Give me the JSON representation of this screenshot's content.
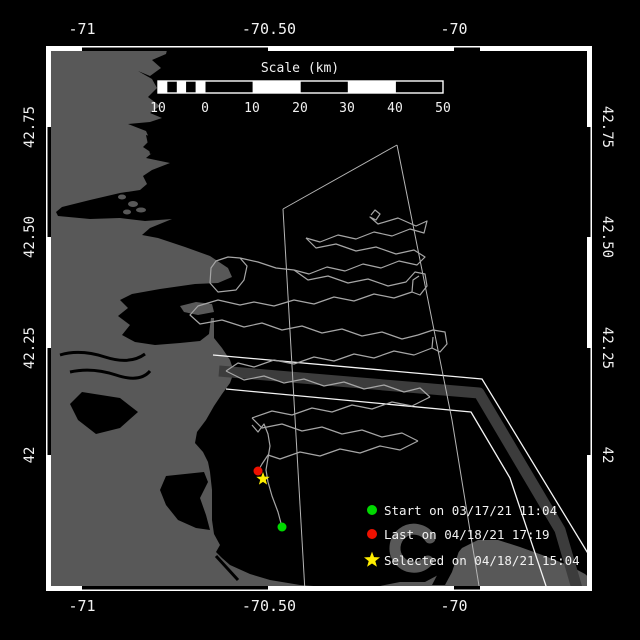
{
  "colors": {
    "background": "#000000",
    "land": "#585858",
    "water": "#000000",
    "frame": "#ffffff",
    "track": "#a6a6a6",
    "survey_line": "#b5b5b5",
    "lane_line": "#f4f4f4",
    "separation_zone": "#3c3c3c",
    "text": "#f2f2f2",
    "start_marker": "#00d800",
    "last_marker": "#ee1100",
    "selected_marker": "#ffee00"
  },
  "top_axis": {
    "ticks": [
      {
        "label": "-71"
      },
      {
        "label": "-70.50"
      },
      {
        "label": "-70"
      }
    ]
  },
  "bottom_axis": {
    "ticks": [
      {
        "label": "-71"
      },
      {
        "label": "-70.50"
      },
      {
        "label": "-70"
      }
    ]
  },
  "left_axis": {
    "ticks": [
      {
        "label": "42.75"
      },
      {
        "label": "42.50"
      },
      {
        "label": "42.25"
      },
      {
        "label": "42"
      }
    ]
  },
  "right_axis": {
    "ticks": [
      {
        "label": "42.75"
      },
      {
        "label": "42.50"
      },
      {
        "label": "42.25"
      },
      {
        "label": "42"
      }
    ]
  },
  "scale_bar": {
    "title": "Scale (km)",
    "tick_labels": [
      "10",
      "0",
      "10",
      "20",
      "30",
      "40",
      "50"
    ]
  },
  "legend": {
    "items": [
      {
        "marker": "circle",
        "color": "#00d800",
        "label": "Start on 03/17/21 11:04"
      },
      {
        "marker": "circle",
        "color": "#ee1100",
        "label": "Last on 04/18/21 17:19"
      },
      {
        "marker": "star",
        "color": "#ffee00",
        "label": "Selected on 04/18/21 15:04"
      }
    ]
  },
  "map": {
    "markers": {
      "start": {
        "x": 282,
        "y": 527
      },
      "last": {
        "x": 258,
        "y": 471
      },
      "selected": {
        "x": 263,
        "y": 479
      }
    },
    "survey_lines": [
      [
        [
          283,
          209
        ],
        [
          397,
          145
        ]
      ],
      [
        [
          397,
          145
        ],
        [
          452,
          420
        ],
        [
          480,
          592
        ]
      ],
      [
        [
          283,
          209
        ],
        [
          305,
          592
        ]
      ]
    ],
    "lane": {
      "north": [
        [
          213,
          355
        ],
        [
          482,
          379
        ],
        [
          592,
          560
        ]
      ],
      "band": [
        [
          219,
          371
        ],
        [
          479,
          393
        ],
        [
          560,
          530
        ],
        [
          578,
          592
        ]
      ],
      "south": [
        [
          226,
          389
        ],
        [
          471,
          412
        ],
        [
          510,
          478
        ],
        [
          548,
          592
        ]
      ]
    },
    "tracks": [
      [
        [
          371,
          215
        ],
        [
          375,
          210
        ],
        [
          380,
          214
        ],
        [
          376,
          220
        ],
        [
          370,
          217
        ],
        [
          378,
          224
        ],
        [
          398,
          218
        ],
        [
          416,
          226
        ],
        [
          427,
          221
        ],
        [
          424,
          233
        ],
        [
          410,
          229
        ],
        [
          392,
          236
        ],
        [
          374,
          232
        ],
        [
          356,
          239
        ],
        [
          338,
          235
        ],
        [
          320,
          242
        ],
        [
          306,
          238
        ]
      ],
      [
        [
          306,
          238
        ],
        [
          316,
          248
        ],
        [
          336,
          244
        ],
        [
          356,
          251
        ],
        [
          376,
          247
        ],
        [
          396,
          254
        ],
        [
          414,
          250
        ],
        [
          425,
          257
        ],
        [
          417,
          265
        ],
        [
          399,
          261
        ],
        [
          381,
          268
        ],
        [
          363,
          264
        ],
        [
          345,
          271
        ],
        [
          327,
          267
        ],
        [
          309,
          274
        ],
        [
          294,
          270
        ]
      ],
      [
        [
          240,
          258
        ],
        [
          247,
          266
        ],
        [
          244,
          280
        ],
        [
          236,
          290
        ],
        [
          218,
          292
        ],
        [
          210,
          283
        ],
        [
          211,
          268
        ],
        [
          216,
          261
        ],
        [
          228,
          257
        ],
        [
          240,
          258
        ],
        [
          258,
          262
        ],
        [
          276,
          268
        ],
        [
          294,
          270
        ]
      ],
      [
        [
          294,
          270
        ],
        [
          308,
          280
        ],
        [
          328,
          276
        ],
        [
          348,
          283
        ],
        [
          368,
          279
        ],
        [
          388,
          286
        ],
        [
          406,
          282
        ],
        [
          415,
          272
        ],
        [
          425,
          274
        ],
        [
          427,
          286
        ],
        [
          420,
          295
        ],
        [
          412,
          292
        ],
        [
          413,
          280
        ],
        [
          419,
          276
        ]
      ],
      [
        [
          412,
          292
        ],
        [
          394,
          298
        ],
        [
          374,
          294
        ],
        [
          354,
          301
        ],
        [
          334,
          297
        ],
        [
          314,
          304
        ],
        [
          294,
          300
        ],
        [
          274,
          306
        ],
        [
          254,
          302
        ],
        [
          240,
          305
        ],
        [
          218,
          300
        ],
        [
          198,
          306
        ],
        [
          190,
          315
        ],
        [
          200,
          324
        ],
        [
          222,
          320
        ],
        [
          244,
          327
        ],
        [
          262,
          323
        ],
        [
          282,
          330
        ],
        [
          302,
          326
        ],
        [
          322,
          333
        ],
        [
          342,
          329
        ],
        [
          362,
          336
        ],
        [
          382,
          332
        ],
        [
          402,
          339
        ],
        [
          418,
          335
        ]
      ],
      [
        [
          418,
          335
        ],
        [
          433,
          330
        ],
        [
          445,
          332
        ],
        [
          447,
          344
        ],
        [
          440,
          352
        ],
        [
          432,
          348
        ],
        [
          433,
          337
        ]
      ],
      [
        [
          432,
          348
        ],
        [
          414,
          355
        ],
        [
          394,
          351
        ],
        [
          374,
          358
        ],
        [
          354,
          354
        ],
        [
          334,
          361
        ],
        [
          314,
          357
        ],
        [
          294,
          364
        ],
        [
          274,
          360
        ],
        [
          254,
          367
        ],
        [
          238,
          363
        ],
        [
          226,
          371
        ]
      ],
      [
        [
          226,
          371
        ],
        [
          244,
          380
        ],
        [
          264,
          376
        ],
        [
          284,
          383
        ],
        [
          304,
          379
        ],
        [
          324,
          386
        ],
        [
          344,
          382
        ],
        [
          364,
          389
        ],
        [
          384,
          385
        ],
        [
          404,
          392
        ],
        [
          420,
          388
        ],
        [
          430,
          397
        ]
      ],
      [
        [
          430,
          397
        ],
        [
          412,
          406
        ],
        [
          392,
          402
        ],
        [
          372,
          409
        ],
        [
          352,
          405
        ],
        [
          332,
          412
        ],
        [
          312,
          408
        ],
        [
          292,
          415
        ],
        [
          272,
          411
        ],
        [
          252,
          418
        ]
      ],
      [
        [
          252,
          418
        ],
        [
          262,
          428
        ],
        [
          282,
          424
        ],
        [
          302,
          431
        ],
        [
          322,
          427
        ],
        [
          342,
          434
        ],
        [
          362,
          430
        ],
        [
          382,
          437
        ],
        [
          402,
          433
        ],
        [
          418,
          441
        ]
      ],
      [
        [
          418,
          441
        ],
        [
          400,
          450
        ],
        [
          380,
          446
        ],
        [
          360,
          453
        ],
        [
          340,
          449
        ],
        [
          320,
          456
        ],
        [
          300,
          452
        ],
        [
          280,
          459
        ],
        [
          268,
          455
        ],
        [
          262,
          464
        ],
        [
          258,
          471
        ]
      ],
      [
        [
          282,
          527
        ],
        [
          278,
          512
        ],
        [
          272,
          496
        ],
        [
          268,
          482
        ],
        [
          266,
          470
        ],
        [
          268,
          458
        ],
        [
          270,
          446
        ],
        [
          268,
          434
        ],
        [
          264,
          424
        ],
        [
          258,
          432
        ],
        [
          252,
          425
        ]
      ]
    ]
  }
}
